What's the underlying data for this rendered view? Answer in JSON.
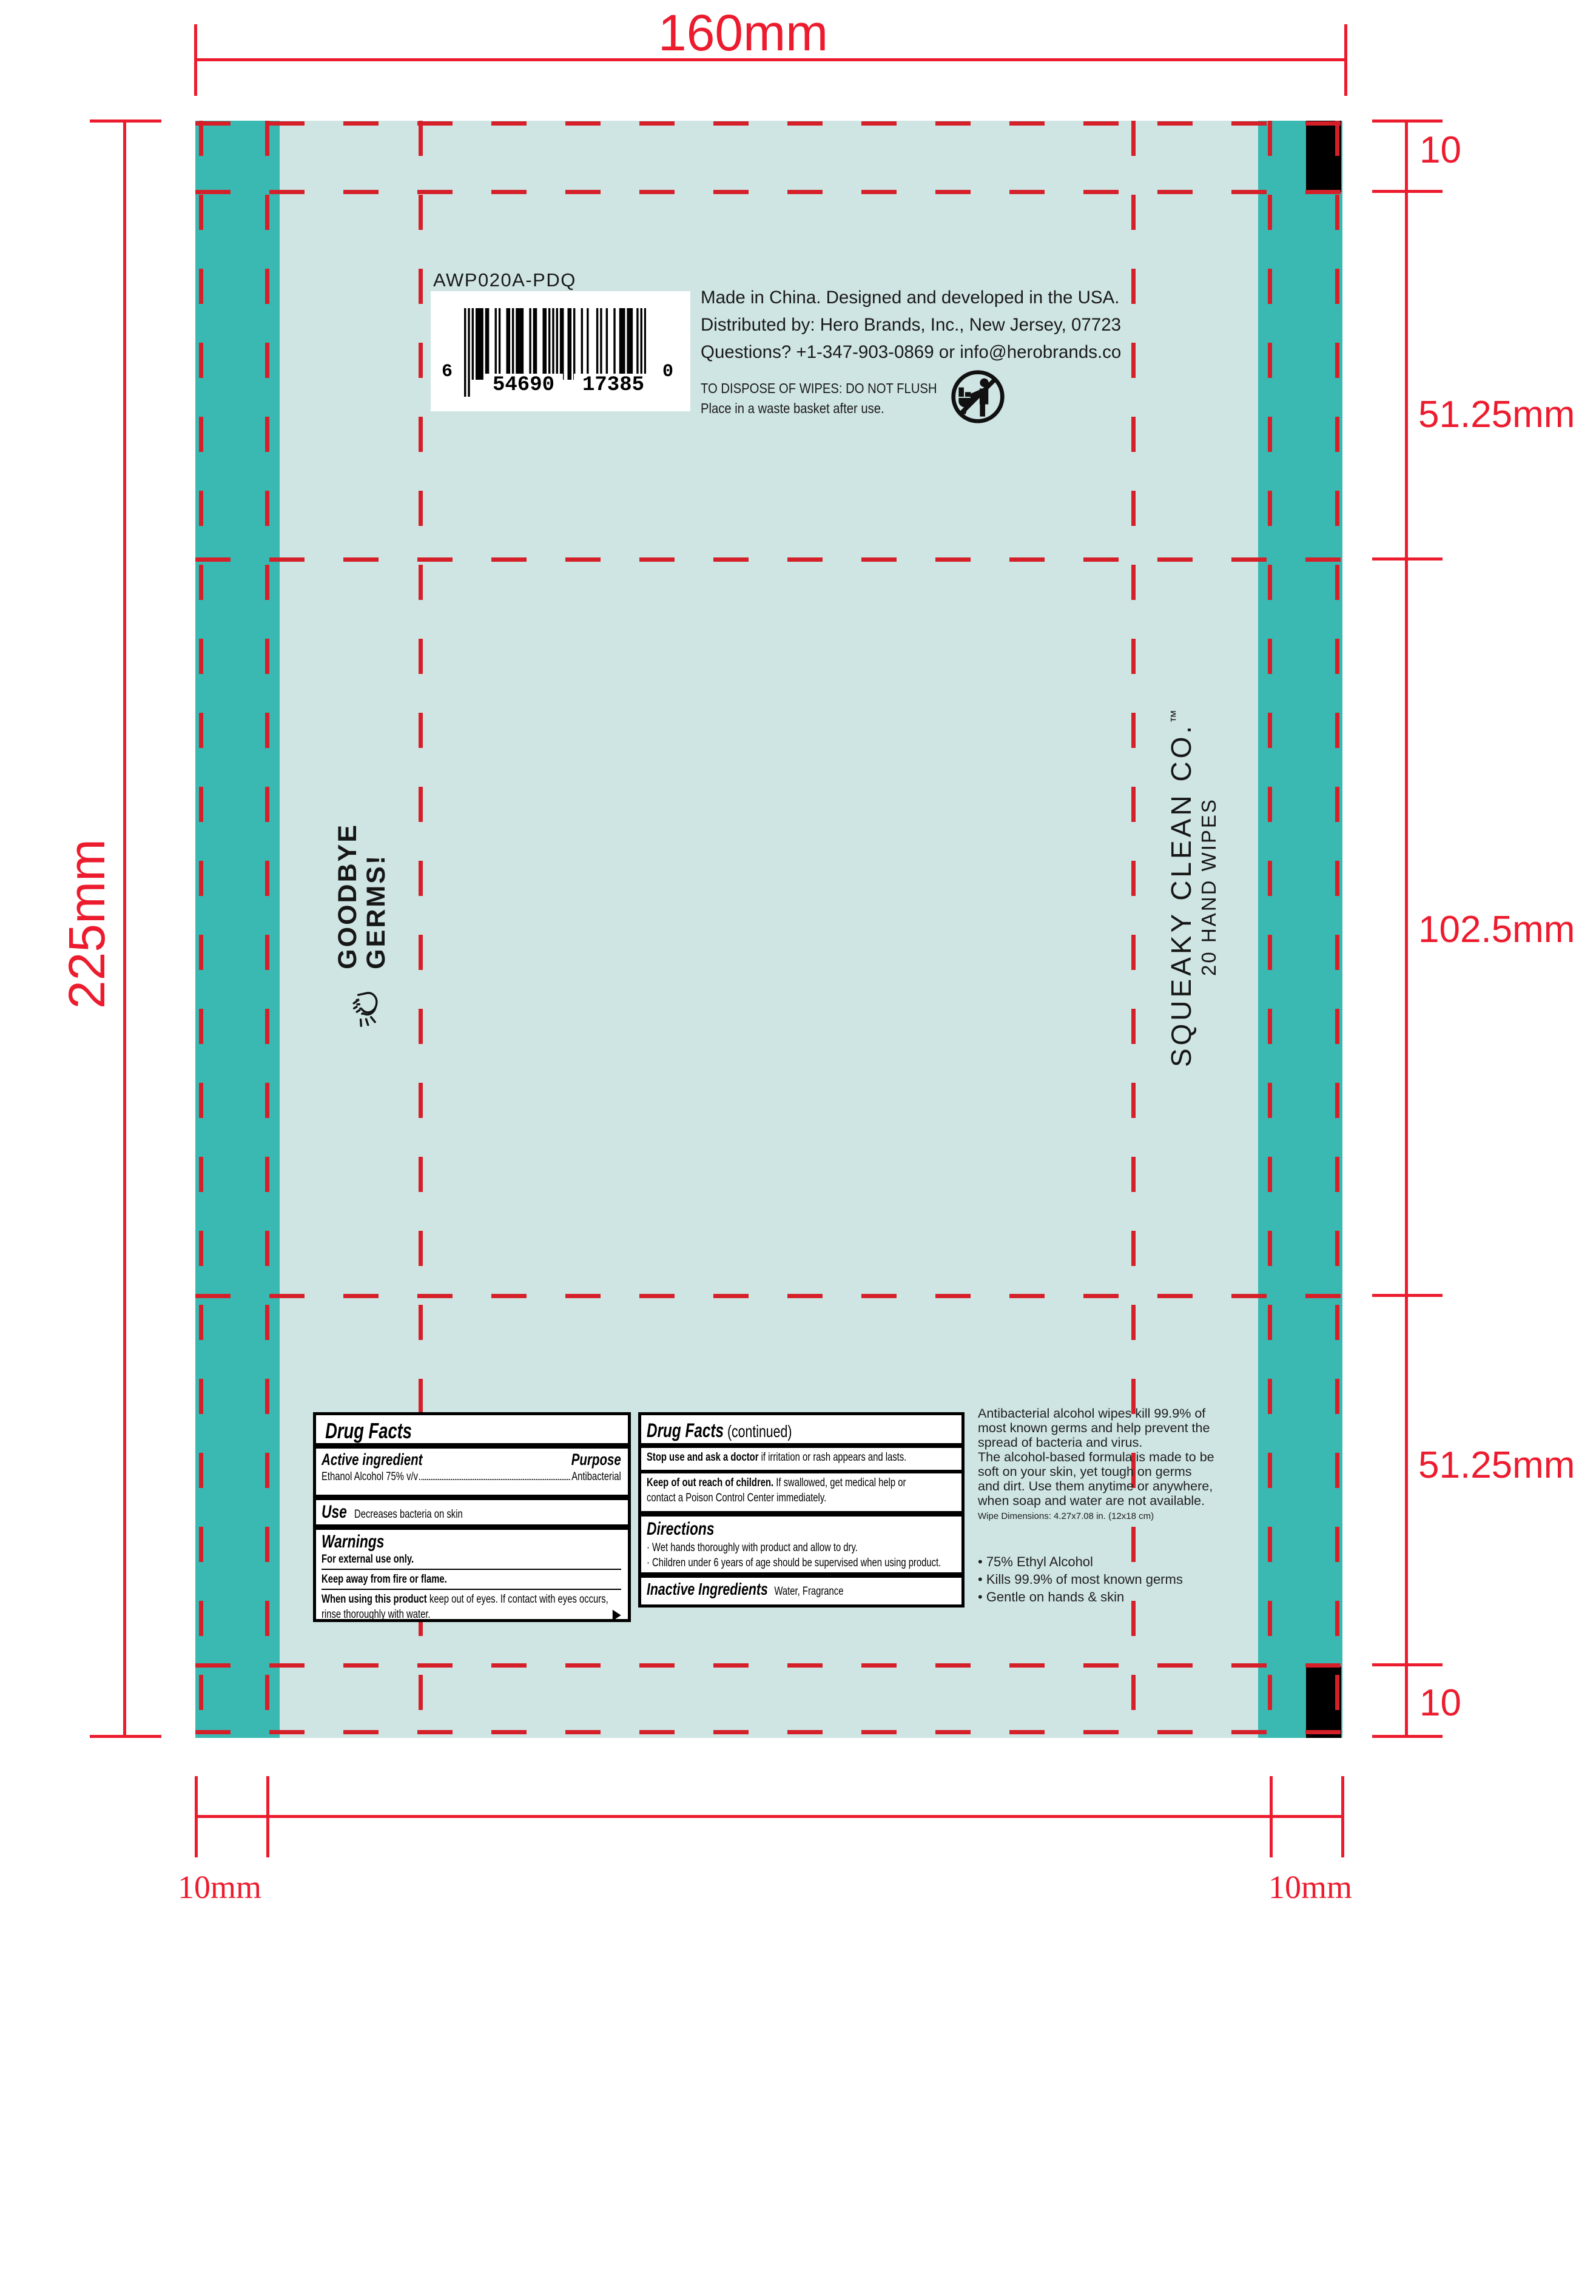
{
  "colors": {
    "package_bg": "#cfe5e3",
    "band": "#3ab8b2",
    "dimension_red": "#ec1c2e",
    "dash_red": "#d5202a",
    "ink": "#1a1a1a"
  },
  "dimensions": {
    "top_width": "160mm",
    "left_height": "225mm",
    "right_zones": [
      "10",
      "51.25mm",
      "102.5mm",
      "51.25mm",
      "10"
    ],
    "bottom_left": "10mm",
    "bottom_right": "10mm"
  },
  "spec": {
    "code": "AWP020A-PDQ"
  },
  "barcode": {
    "left_digit": "6",
    "group1": "54690",
    "group2": "17385",
    "right_digit": "0",
    "modules": "10101011110110001010001101011110001011000110101010110011010001001000010100100010011101110010101"
  },
  "back_panel": {
    "distribution_lines": [
      "Made in China. Designed and developed in the USA.",
      "Distributed by: Hero Brands, Inc., New Jersey, 07723",
      "Questions? +1-347-903-0869 or info@herobrands.co"
    ],
    "disposal_line1": "TO DISPOSE OF WIPES: DO NOT FLUSH",
    "disposal_line2": "Place in a waste basket after use."
  },
  "side_panel": {
    "tagline_line1": "GOODBYE",
    "tagline_line2": "GERMS!"
  },
  "brand_panel": {
    "brand": "SQUEAKY CLEAN CO.",
    "tm": "™",
    "count_line": "20 HAND WIPES"
  },
  "drug_facts": {
    "title": "Drug Facts",
    "continued_title": "Drug Facts",
    "continued_suffix": " (continued)",
    "active_heading": "Active ingredient",
    "purpose_heading": "Purpose",
    "active_value": "Ethanol Alcohol 75% v/v",
    "purpose_value": "Antibacterial",
    "use_heading": "Use",
    "use_value": "Decreases bacteria on skin",
    "warnings_heading": "Warnings",
    "warning_external": "For external use only.",
    "warning_fire": "Keep away from fire or flame.",
    "warning_eyes_lead": "When using this product",
    "warning_eyes_rest": " keep out of eyes. If contact with eyes occurs,",
    "warning_eyes_line2": "rinse thoroughly with water.",
    "continue_arrow": "▶",
    "stop_lead": "Stop use and ask a doctor",
    "stop_rest": " if irritation or rash appears and lasts.",
    "children_lead": "Keep of out reach of children.",
    "children_rest": " If swallowed, get medical help or",
    "children_line2": "contact a Poison Control Center immediately.",
    "directions_heading": "Directions",
    "directions_items": [
      "· Wet hands thoroughly with product and allow to dry.",
      "· Children under 6 years of age should be supervised when using product."
    ],
    "inactive_heading": "Inactive Ingredients",
    "inactive_value": "Water, Fragrance"
  },
  "marketing": {
    "paragraph_lines": [
      "Antibacterial alcohol wipes kill 99.9% of",
      "most known germs and help prevent the",
      "spread of bacteria and virus.",
      "The alcohol-based formula is made to be",
      "soft on your skin, yet tough on germs",
      "and dirt. Use them anytime or anywhere,",
      "when soap and water are not available."
    ],
    "note": "Wipe Dimensions: 4.27x7.08 in. (12x18 cm)",
    "bullets": [
      "• 75% Ethyl Alcohol",
      "• Kills 99.9% of most known germs",
      "• Gentle on hands & skin"
    ]
  }
}
